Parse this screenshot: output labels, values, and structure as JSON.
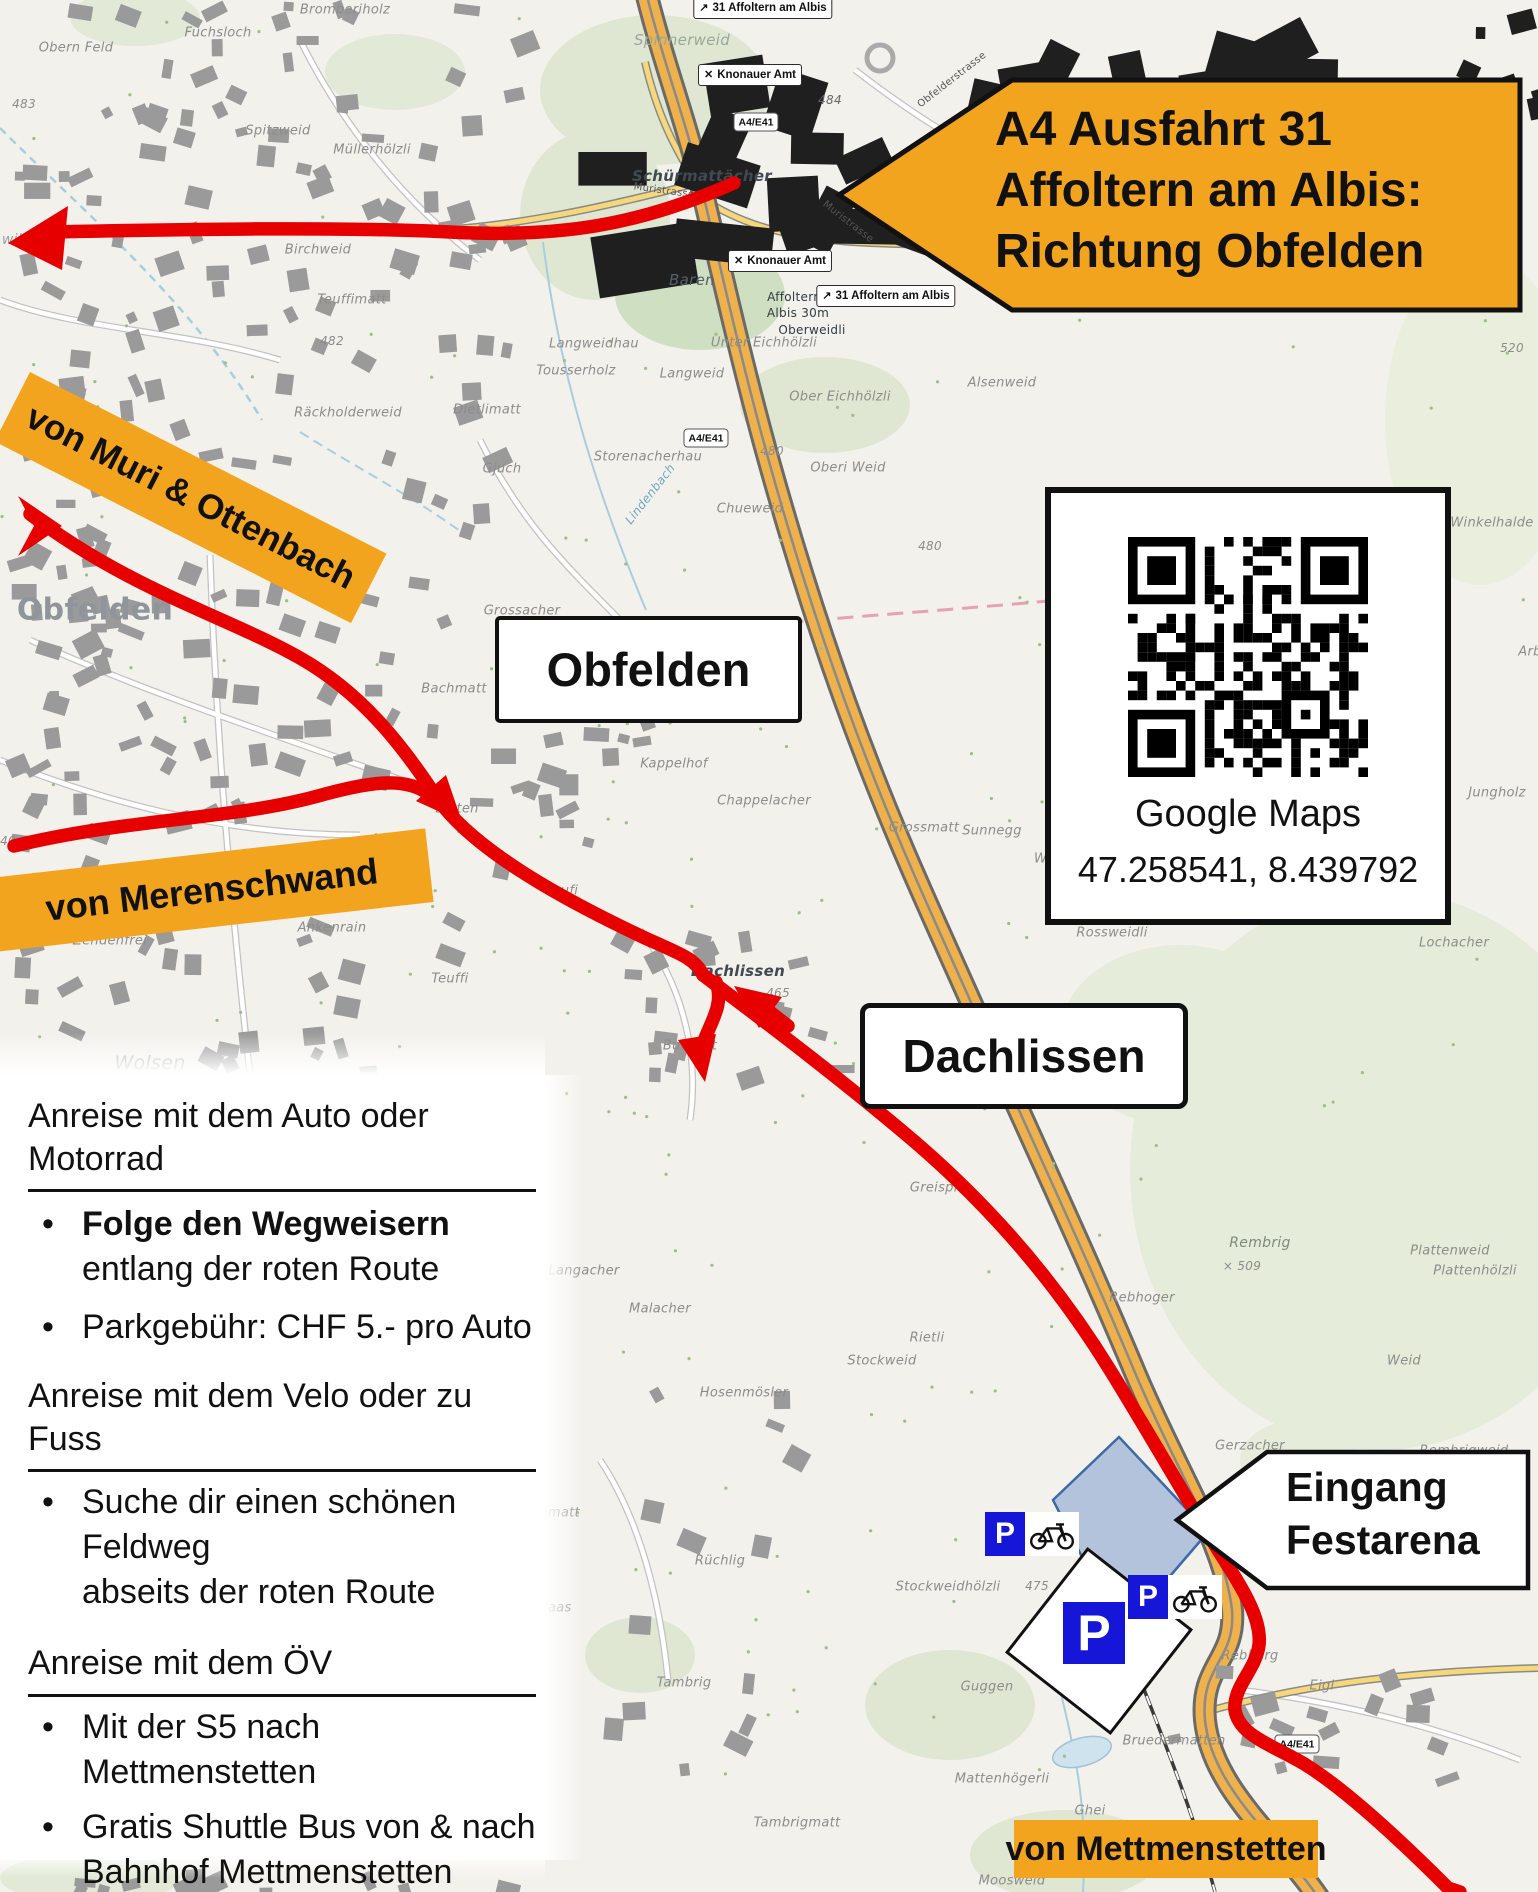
{
  "exit_sign": {
    "lines": [
      "A4 Ausfahrt 31",
      "Affoltern am Albis:",
      "Richtung Obfelden"
    ]
  },
  "entrance_sign": {
    "line1": "Eingang",
    "line2": "Festarena"
  },
  "origin_labels": {
    "muri": "von Muri & Ottenbach",
    "merenschwand": "von Merenschwand",
    "mettmenstetten": "von Mettmenstetten"
  },
  "place_boxes": {
    "obfelden": "Obfelden",
    "dachlissen": "Dachlissen"
  },
  "qr_card": {
    "caption": "Google Maps",
    "coords": "47.258541, 8.439792"
  },
  "parking": {
    "p_label": "P"
  },
  "info_panel": {
    "sections": [
      {
        "heading": "Anreise mit dem Auto oder Motorrad",
        "items": [
          {
            "bold": "Folge den Wegweisern",
            "lines": [
              "entlang der roten Route"
            ]
          },
          {
            "lines": [
              "Parkgebühr: CHF 5.- pro Auto"
            ]
          }
        ]
      },
      {
        "heading": "Anreise mit dem Velo oder zu Fuss",
        "items": [
          {
            "lines": [
              "Suche dir einen schönen Feldweg",
              "abseits der roten Route"
            ]
          }
        ]
      },
      {
        "heading": "Anreise mit dem ÖV",
        "items": [
          {
            "lines": [
              "Mit der S5 nach Mettmenstetten"
            ]
          },
          {
            "lines": [
              "Gratis Shuttle Bus von & nach",
              "Bahnhof Mettmenstetten"
            ]
          }
        ]
      }
    ]
  },
  "colors": {
    "accent_orange": "#F2A41F",
    "route_red": "#E60000",
    "parking_blue": "#1616D8",
    "arena_blue": "#7D9ECF"
  },
  "badges": [
    {
      "kind": "poi",
      "icon": "✕",
      "t": "Knonauer Amt",
      "x": 750,
      "y": 75
    },
    {
      "kind": "poi",
      "icon": "✕",
      "t": "Knonauer Amt",
      "x": 780,
      "y": 261
    },
    {
      "kind": "exit",
      "icon": "↗",
      "t": "31 Affoltern am Albis",
      "x": 763,
      "y": 8
    },
    {
      "kind": "exit",
      "icon": "↗",
      "t": "31 Affoltern am Albis",
      "x": 886,
      "y": 296
    },
    {
      "kind": "shield",
      "t": "A4/E41",
      "x": 756,
      "y": 122
    },
    {
      "kind": "shield",
      "t": "A4/E41",
      "x": 706,
      "y": 438
    },
    {
      "kind": "shield",
      "t": "A4/E41",
      "x": 1297,
      "y": 1744
    },
    {
      "kind": "shield",
      "t": "382",
      "x": 1428,
      "y": 877
    }
  ],
  "map_labels": [
    {
      "t": "Bromberiholz",
      "x": 345,
      "y": 10
    },
    {
      "t": "Fuchsloch",
      "x": 218,
      "y": 33
    },
    {
      "t": "Obern Feld",
      "x": 76,
      "y": 48
    },
    {
      "t": "483",
      "x": 24,
      "y": 104,
      "s": 12
    },
    {
      "t": "Spitzweid",
      "x": 278,
      "y": 131
    },
    {
      "t": "Müllerhölzli",
      "x": 372,
      "y": 150
    },
    {
      "t": "Spinnerweid",
      "x": 682,
      "y": 40,
      "s": 15,
      "c": "#9aa79a"
    },
    {
      "t": "Schürmattächer",
      "x": 702,
      "y": 176,
      "s": 15,
      "c": "#3f4a52",
      "w": 1
    },
    {
      "t": "Baren",
      "x": 692,
      "y": 280,
      "s": 15,
      "c": "#55606a"
    },
    {
      "t": "Birchweid",
      "x": 318,
      "y": 250
    },
    {
      "t": "wil",
      "x": 12,
      "y": 240,
      "s": 14,
      "c": "#9aa0a6"
    },
    {
      "t": "Teuffimatt",
      "x": 352,
      "y": 300
    },
    {
      "t": "482",
      "x": 332,
      "y": 341,
      "s": 12
    },
    {
      "t": "Räckholderweid",
      "x": 348,
      "y": 413
    },
    {
      "t": "Dietlimatt",
      "x": 487,
      "y": 410
    },
    {
      "t": "Langweidhau",
      "x": 594,
      "y": 344
    },
    {
      "t": "Tousserholz",
      "x": 576,
      "y": 371
    },
    {
      "t": "Langweid",
      "x": 692,
      "y": 374
    },
    {
      "t": "Unter Eichhölzli",
      "x": 764,
      "y": 343
    },
    {
      "t": "Ober Eichhölzli",
      "x": 840,
      "y": 397
    },
    {
      "t": "Alsenweid",
      "x": 1002,
      "y": 383
    },
    {
      "t": "520",
      "x": 1512,
      "y": 348,
      "s": 12
    },
    {
      "t": "Storenacherhau",
      "x": 648,
      "y": 457
    },
    {
      "t": "Gjuch",
      "x": 502,
      "y": 469
    },
    {
      "t": "480",
      "x": 772,
      "y": 451,
      "s": 12
    },
    {
      "t": "Oberi Weid",
      "x": 848,
      "y": 468
    },
    {
      "t": "Chueweid",
      "x": 750,
      "y": 509
    },
    {
      "t": "Winkelhalde",
      "x": 1492,
      "y": 523
    },
    {
      "t": "Obfelden",
      "x": 95,
      "y": 610,
      "s": 30,
      "c": "#8f959b",
      "w": 1,
      "ni": 1
    },
    {
      "t": "Toussen",
      "x": 322,
      "y": 566
    },
    {
      "t": "Grossacher",
      "x": 522,
      "y": 611
    },
    {
      "t": "Weid",
      "x": 642,
      "y": 626
    },
    {
      "t": "477",
      "x": 608,
      "y": 641,
      "s": 11
    },
    {
      "t": "483",
      "x": 597,
      "y": 663,
      "s": 12
    },
    {
      "t": "Müllerweid",
      "x": 672,
      "y": 662
    },
    {
      "t": "Bachmatt",
      "x": 454,
      "y": 689
    },
    {
      "t": "Mutzenberg",
      "x": 584,
      "y": 693
    },
    {
      "t": "Kappelhof",
      "x": 674,
      "y": 764
    },
    {
      "t": "Chappelacher",
      "x": 764,
      "y": 801
    },
    {
      "t": "494",
      "x": 1247,
      "y": 776,
      "s": 12
    },
    {
      "t": "Jungholz",
      "x": 1497,
      "y": 793
    },
    {
      "t": "Latten",
      "x": 457,
      "y": 809
    },
    {
      "t": "Grossmatt",
      "x": 924,
      "y": 828
    },
    {
      "t": "Sunnegg",
      "x": 992,
      "y": 831
    },
    {
      "t": "Weidliacher",
      "x": 1074,
      "y": 859
    },
    {
      "t": "Rossweidli",
      "x": 1112,
      "y": 933
    },
    {
      "t": "Lochacher",
      "x": 1454,
      "y": 943
    },
    {
      "t": "Teufi",
      "x": 562,
      "y": 891
    },
    {
      "t": "Teuffi",
      "x": 450,
      "y": 979
    },
    {
      "t": "Wolsen",
      "x": 150,
      "y": 1063,
      "s": 19,
      "c": "#a7abb1"
    },
    {
      "t": "Zendenfrei",
      "x": 110,
      "y": 941
    },
    {
      "t": "Ankenrain",
      "x": 332,
      "y": 928
    },
    {
      "t": "Dachlissen",
      "x": 738,
      "y": 971,
      "s": 15,
      "c": "#3f4a52",
      "w": 1
    },
    {
      "t": "465",
      "x": 778,
      "y": 993,
      "s": 12
    },
    {
      "t": "Greispitz",
      "x": 940,
      "y": 1188
    },
    {
      "t": "Bungert",
      "x": 690,
      "y": 1046
    },
    {
      "t": "Rembrig",
      "x": 1260,
      "y": 1243,
      "s": 14,
      "c": "#7d8a7a"
    },
    {
      "t": "× 509",
      "x": 1242,
      "y": 1266,
      "s": 12
    },
    {
      "t": "Plattenweid",
      "x": 1450,
      "y": 1251
    },
    {
      "t": "Plattenhölzli",
      "x": 1475,
      "y": 1271
    },
    {
      "t": "Rebhoger",
      "x": 1142,
      "y": 1298
    },
    {
      "t": "Langacher",
      "x": 584,
      "y": 1271
    },
    {
      "t": "Malacher",
      "x": 660,
      "y": 1309
    },
    {
      "t": "Rietli",
      "x": 927,
      "y": 1338
    },
    {
      "t": "Stockweid",
      "x": 882,
      "y": 1361
    },
    {
      "t": "Hosenmösler",
      "x": 744,
      "y": 1393
    },
    {
      "t": "Weid",
      "x": 1404,
      "y": 1361
    },
    {
      "t": "Gerzacher",
      "x": 1250,
      "y": 1446
    },
    {
      "t": "Rembrigweid",
      "x": 1464,
      "y": 1451
    },
    {
      "t": "Stockweidhölzli",
      "x": 948,
      "y": 1587
    },
    {
      "t": "Rüchlig",
      "x": 720,
      "y": 1561
    },
    {
      "t": "limatt",
      "x": 560,
      "y": 1513
    },
    {
      "t": "Maas",
      "x": 554,
      "y": 1608
    },
    {
      "t": "Tambrig",
      "x": 684,
      "y": 1683
    },
    {
      "t": "Guggen",
      "x": 987,
      "y": 1687
    },
    {
      "t": "Rebberg",
      "x": 1250,
      "y": 1656
    },
    {
      "t": "Eigi",
      "x": 1322,
      "y": 1686
    },
    {
      "t": "Bruedermatten",
      "x": 1174,
      "y": 1741
    },
    {
      "t": "Mattenhögerli",
      "x": 1002,
      "y": 1779
    },
    {
      "t": "Ghei",
      "x": 1090,
      "y": 1811
    },
    {
      "t": "Tambrigmatt",
      "x": 797,
      "y": 1823
    },
    {
      "t": "Moosweid",
      "x": 1012,
      "y": 1881
    },
    {
      "t": "475",
      "x": 1037,
      "y": 1586,
      "s": 12
    },
    {
      "t": "484",
      "x": 830,
      "y": 100,
      "s": 12,
      "c": "#666666"
    },
    {
      "t": "480",
      "x": 930,
      "y": 546,
      "s": 12
    },
    {
      "t": "40",
      "x": 8,
      "y": 841,
      "s": 12
    },
    {
      "t": "Affoltern am",
      "x": 806,
      "y": 297,
      "s": 12,
      "c": "#2f3a42",
      "ni": 1
    },
    {
      "t": "Albis 30m",
      "x": 798,
      "y": 313,
      "s": 12,
      "c": "#2f3a42",
      "ni": 1
    },
    {
      "t": "Oberweidli",
      "x": 812,
      "y": 330,
      "s": 12,
      "c": "#2f3a42",
      "ni": 1
    },
    {
      "t": "Lindenbach",
      "x": 650,
      "y": 494,
      "s": 12,
      "c": "#6fa8c0",
      "r": -52
    },
    {
      "t": "Muristrasse",
      "x": 664,
      "y": 191,
      "s": 10,
      "c": "#555555",
      "r": 8,
      "ni": 1
    },
    {
      "t": "Muristrasse",
      "x": 848,
      "y": 222,
      "s": 10,
      "c": "#555555",
      "r": 38,
      "ni": 1
    },
    {
      "t": "Obfelderstrasse",
      "x": 952,
      "y": 80,
      "s": 10,
      "c": "#555555",
      "r": -38,
      "ni": 1
    },
    {
      "t": "Arb",
      "x": 1530,
      "y": 652
    }
  ]
}
